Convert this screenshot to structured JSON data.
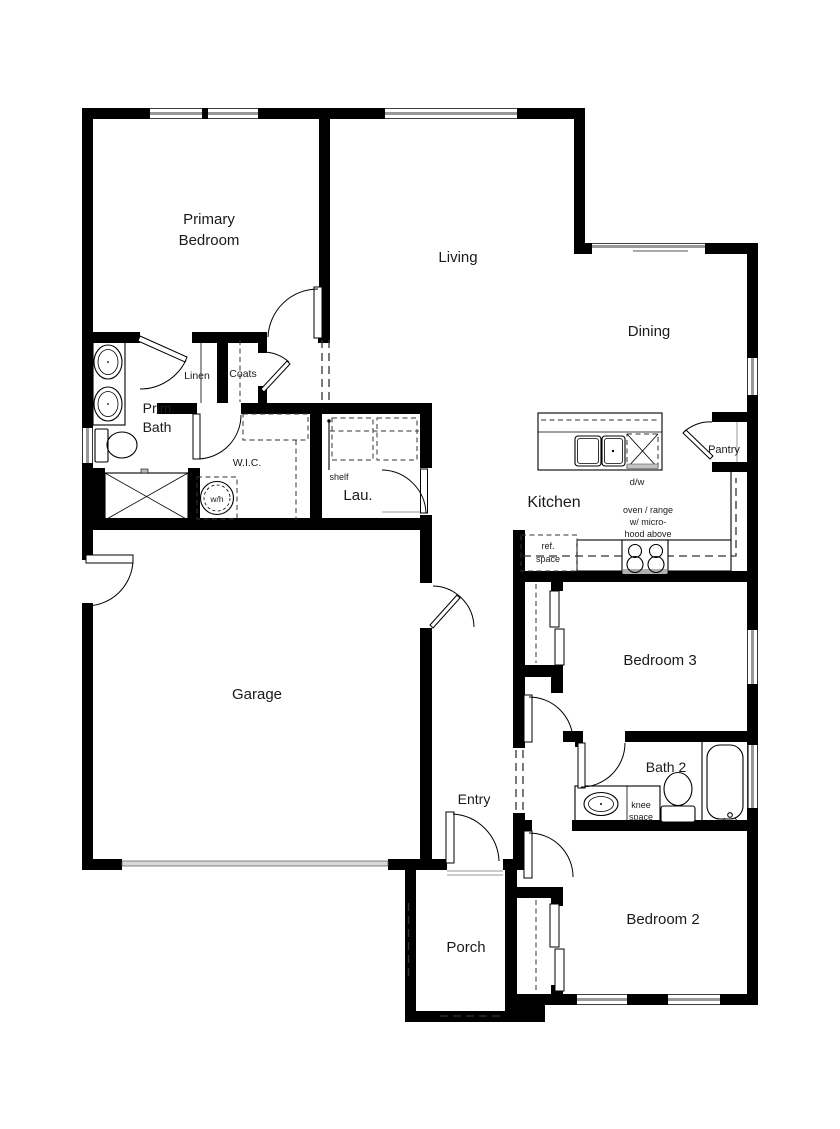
{
  "plan": {
    "type": "single-story residential floor plan",
    "rooms": {
      "primary_bedroom": {
        "line1": "Primary",
        "line2": "Bedroom"
      },
      "living": "Living",
      "dining": "Dining",
      "prim_bath": {
        "line1": "Prim.",
        "line2": "Bath"
      },
      "linen": "Linen",
      "coats": "Coats",
      "wic": "W.I.C.",
      "laundry": "Lau.",
      "kitchen": "Kitchen",
      "pantry": "Pantry",
      "garage": "Garage",
      "bedroom3": "Bedroom 3",
      "bath2": "Bath 2",
      "entry": "Entry",
      "porch": "Porch",
      "bedroom2": "Bedroom 2"
    },
    "annotations": {
      "shelf": "shelf",
      "water_heater": "w/h",
      "dishwasher": "d/w",
      "oven": {
        "line1": "oven / range",
        "line2": "w/ micro-",
        "line3": "hood above"
      },
      "ref": {
        "line1": "ref.",
        "line2": "space"
      },
      "knee": {
        "line1": "knee",
        "line2": "space"
      }
    },
    "colors": {
      "wall": "#000000",
      "window_glass": "#999999",
      "background": "#ffffff",
      "text": "#1a1a1a"
    }
  }
}
